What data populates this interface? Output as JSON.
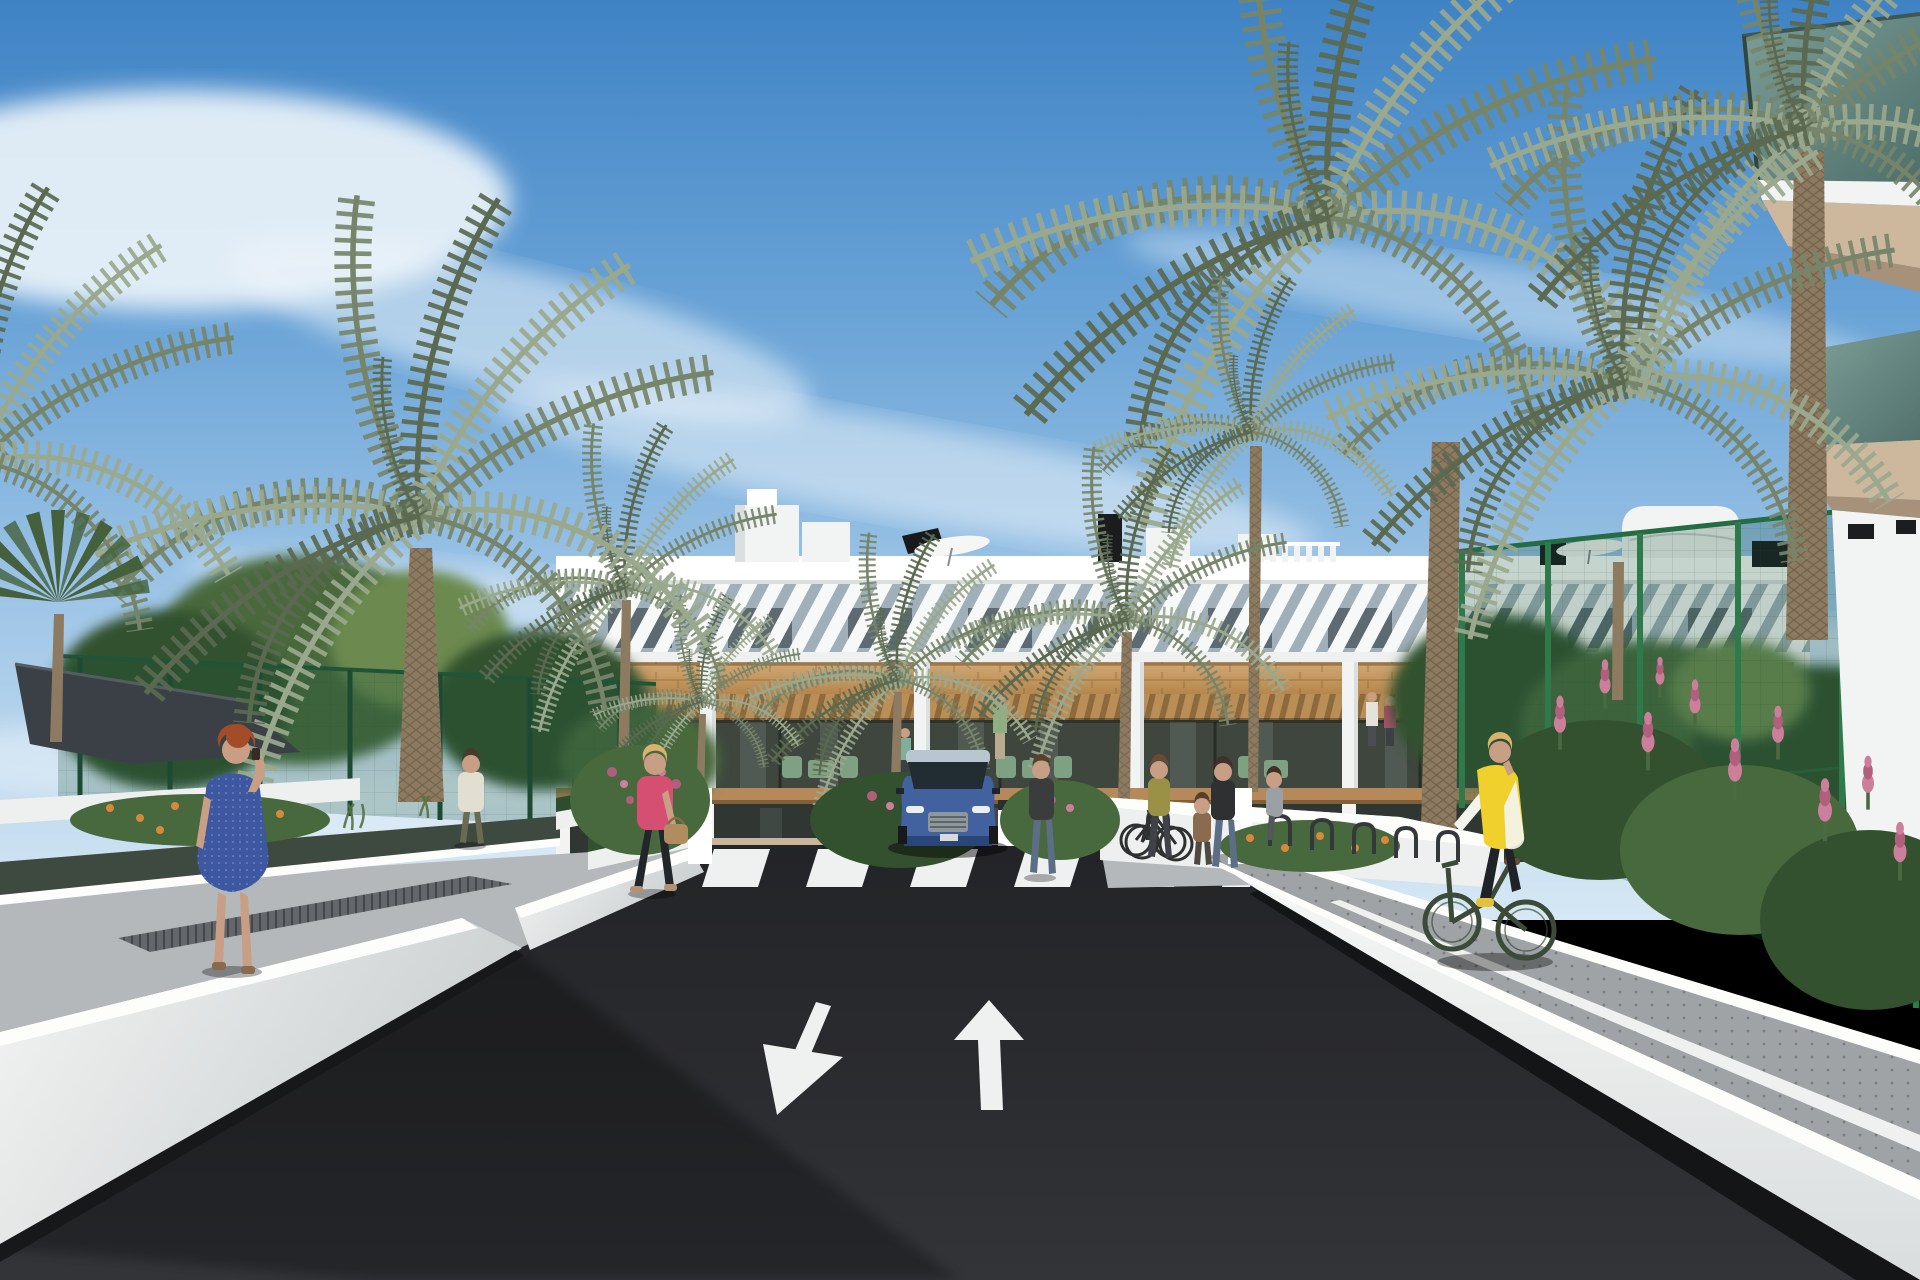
{
  "scene": {
    "title": "Sunny 3D architectural rendering: street approach to a modern white three-storey apartment complex with palm trees, pedestrians and a cyclist",
    "type": "exterior-render",
    "weather": "clear blue sky with wispy cirrus clouds"
  },
  "palette": {
    "sky_top": "#3f83c5",
    "sky_mid": "#7db3e0",
    "sky_horizon": "#d6e8f4",
    "cloud_white": "#eef5fa",
    "building_white": "#f2f4f3",
    "building_shade": "#dbe0df",
    "parapet_bright": "#ffffff",
    "louver_gap": "#a7b6c0",
    "window_dark": "#2e373d",
    "wood_band": "#c59a63",
    "wood_dark": "#b5895a",
    "pergola_wood": "#b98e57",
    "balcony_interior": "#3e463e",
    "furniture_green": "#7fa183",
    "balcony_glass": "#6f8e85",
    "soffit_beige": "#cdb89e",
    "soffit_dark": "#a8917a",
    "fence_green": "#1f5438",
    "mesh_green": "rgba(29,84,58,0.25)",
    "foliage_dark": "#33512f",
    "foliage_mid": "#48693d",
    "foliage_light": "#6c8a50",
    "palm_light": "#9aa88d",
    "palm_mid": "#76856a",
    "palm_dark": "#5a6950",
    "trunk_brown": "#8d7b61",
    "sail_gray": "#3b4046",
    "asphalt_dark": "#26272a",
    "asphalt_mid": "#313336",
    "marking_white": "#eff1f0",
    "wall_white": "#eef0ef",
    "wall_bright": "#fdfdfc",
    "wall_shade": "#cfd4d4",
    "path_gray": "#b4b8bb",
    "cycle_path_gray": "#9fa3a5",
    "grate_gray": "#63666a",
    "court_beige": "#c8b59b",
    "flower_pink": "#cc7f9b",
    "flower_magenta": "#b05f7d",
    "flower_orange": "#d6893c",
    "car_blue": "#41629f",
    "car_blue_dark": "#2a4678",
    "car_glass": "#222c33",
    "skin_tone": "#c89e85",
    "hair_red": "#a34d28",
    "hair_blonde": "#d9b36b",
    "dress_blue": "#3d57a0",
    "jacket_pink": "#d44f72",
    "vest_yellow": "#f0d02c",
    "jeans_blue": "#5c6e85",
    "bag_tan": "#b08d5f",
    "bike_dark": "#3c4a38"
  },
  "road": {
    "surface": "dark asphalt two-way drive",
    "markings": [
      "zebra pedestrian crossing in front of entrance",
      "large white arrow pointing toward viewer (left lane)",
      "large white arrow pointing away from viewer (right lane)",
      "small arrow pair beside the crossing"
    ]
  },
  "building": {
    "storeys": 3,
    "style": "white render, diagonal louvre screen on top floor, timber cladding band, timber pergola balconies",
    "rooftop_items": [
      "stair core",
      "white parasol",
      "second white parasol",
      "black chimneys",
      "air-conditioning units",
      "slatted roof terrace railing"
    ],
    "foreground_right": "close-up corner of sister block with green glass balconies, beige soffits, black wall lamps and wicker chair"
  },
  "people": [
    {
      "id": "woman-blue-dress",
      "description": "red-haired woman in blue patterned dress standing on left walkway, phone to ear"
    },
    {
      "id": "woman-pink-jacket",
      "description": "blonde woman in pink jacket carrying tan handbag, walking left on walkway"
    },
    {
      "id": "man-walking-away",
      "description": "man in light shirt and olive trousers walking toward the complex on the left path"
    },
    {
      "id": "woman-by-car",
      "description": "woman standing beside the blue SUV at the entrance court"
    },
    {
      "id": "woman-with-bicycle",
      "description": "woman wheeling a bicycle near the bike racks"
    },
    {
      "id": "adult-with-child",
      "description": "adult and child beside the entrance planting"
    },
    {
      "id": "woman-grey-top",
      "description": "woman standing further along the bike racks"
    },
    {
      "id": "cyclist-yellow-vest",
      "description": "blonde woman in yellow gilet riding a dark green bicycle on the right-hand path"
    },
    {
      "id": "balcony-residents",
      "description": "small resident figures on first-floor balconies"
    }
  ],
  "vehicles": [
    {
      "id": "blue-suv",
      "description": "blue SUV facing viewer at entrance courtyard"
    },
    {
      "id": "parked-bicycles",
      "description": "bicycles in racks along the entrance wall"
    }
  ],
  "vegetation": {
    "palms": "tall date palms right and left, smaller palms in front of facade, fan palm far left",
    "shrubs": "pink flower spikes behind green mesh fence (right), rose bushes centre-left, orange flower beds along both paths"
  },
  "structures": [
    "dark grey shade sail upper left",
    "green wire mesh fences both sides",
    "white ramp parapet walls framing the asphalt drive"
  ]
}
